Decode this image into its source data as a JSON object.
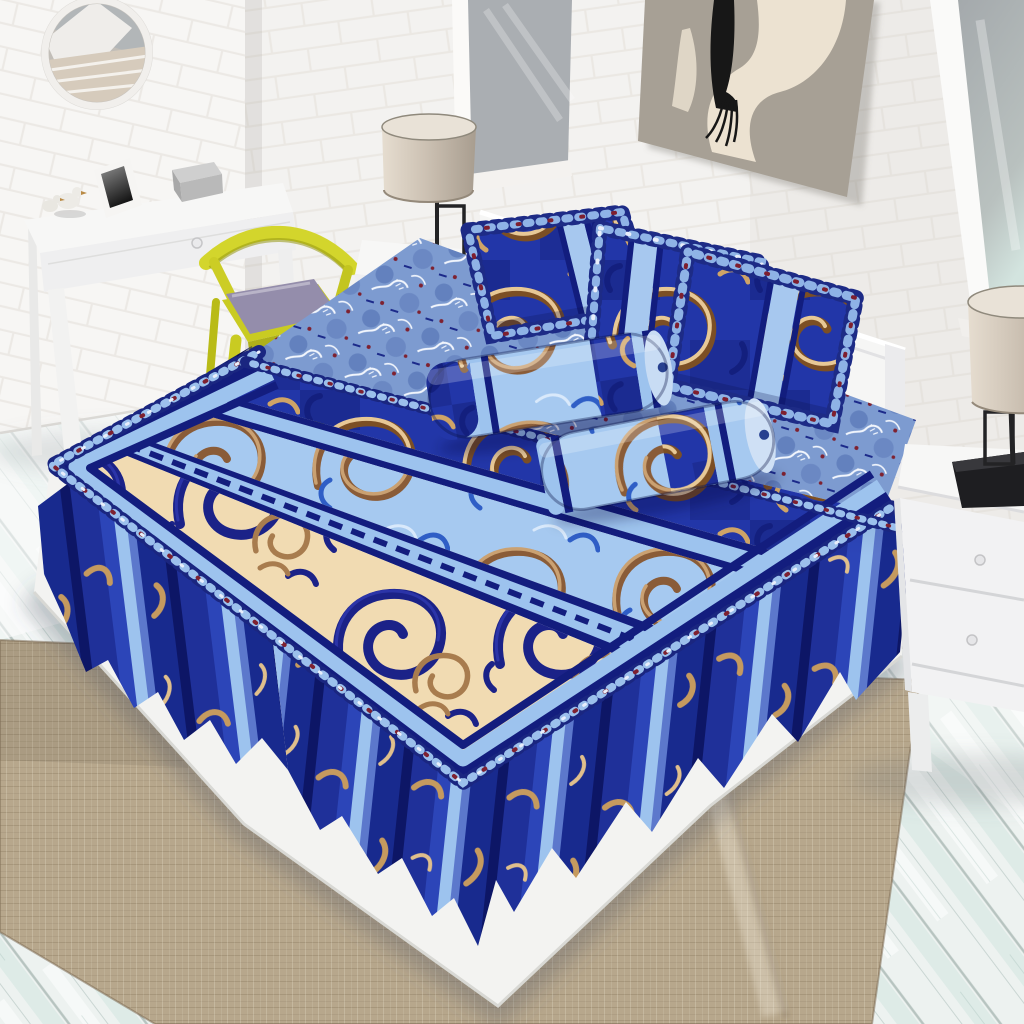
{
  "meta": {
    "type": "product-photo",
    "subject": "Blue ornamental bed-skirt bedding set (sprei) staged in a white brick bedroom",
    "style": "3D render, no visible text"
  },
  "scene": {
    "room": {
      "walls": "white painted brick, corner at upper left",
      "floor": "whitewashed pale teal wood planks",
      "rug": "natural burlap / jute area rug under bed"
    },
    "objects": [
      {
        "name": "round-mirror",
        "desc": "white framed round wall mirror reflecting a window"
      },
      {
        "name": "console-table",
        "desc": "white table with drawer, photo frame, two bird figurines, grey box"
      },
      {
        "name": "accent-chair",
        "desc": "yellow wood chair with purple seat cushion"
      },
      {
        "name": "wall-art",
        "desc": "taupe canvas with abstract cream figure and black hair"
      },
      {
        "name": "window-left",
        "desc": "grey glazed window on back wall"
      },
      {
        "name": "window-right",
        "desc": "tall grey glazed window on right wall"
      },
      {
        "name": "nightstand-left",
        "desc": "white nightstand with black-base drum lamp"
      },
      {
        "name": "nightstand-right",
        "desc": "white two-drawer nightstand with black-base drum lamp"
      },
      {
        "name": "bed",
        "desc": "queen bed with ruffled pillow shams, two bolsters, striped ornamental bedspread, pleated bed skirt, white platform base"
      }
    ],
    "bedding": {
      "pillows": 3,
      "bolsters": 2,
      "pattern": "baroque gold scrolls on royal blue, brown scrolls on powder blue, navy scrolls on cream, striped borders, lace ruffle trim"
    }
  },
  "colors": {
    "wall": "#f3f2f0",
    "mortar": "#e9e6e1",
    "floor": "#edf2f0",
    "rug": "#b7a78c",
    "glass": "#aaaeb2",
    "white_furniture": "#f7f7f6",
    "art_canvas": "#a7a095",
    "art_figure": "#ece2d1",
    "art_hair": "#171717",
    "chair_yellow": "#d3d52c",
    "chair_yellow_dark": "#aeb01a",
    "cushion_purple": "#948dab",
    "lamp_shade": "#cbc0b2",
    "lamp_metal": "#222225",
    "bedding_royal": "#2236a8",
    "bedding_navy": "#131d7e",
    "bedding_deep": "#0d1666",
    "bedding_steel": "#9dc3ee",
    "bedding_powder": "#a6c9f0",
    "bedding_cream": "#f1dbb2",
    "bedding_sheet": "#7d9bd0",
    "gold": "#c59a63",
    "gold_light": "#e7c896",
    "gold_dark": "#7c4f24",
    "brown": "#a87c4e",
    "lace_red": "#7e2130",
    "platform_white": "#f3f3f1",
    "headboard": "#f6f6f5"
  }
}
